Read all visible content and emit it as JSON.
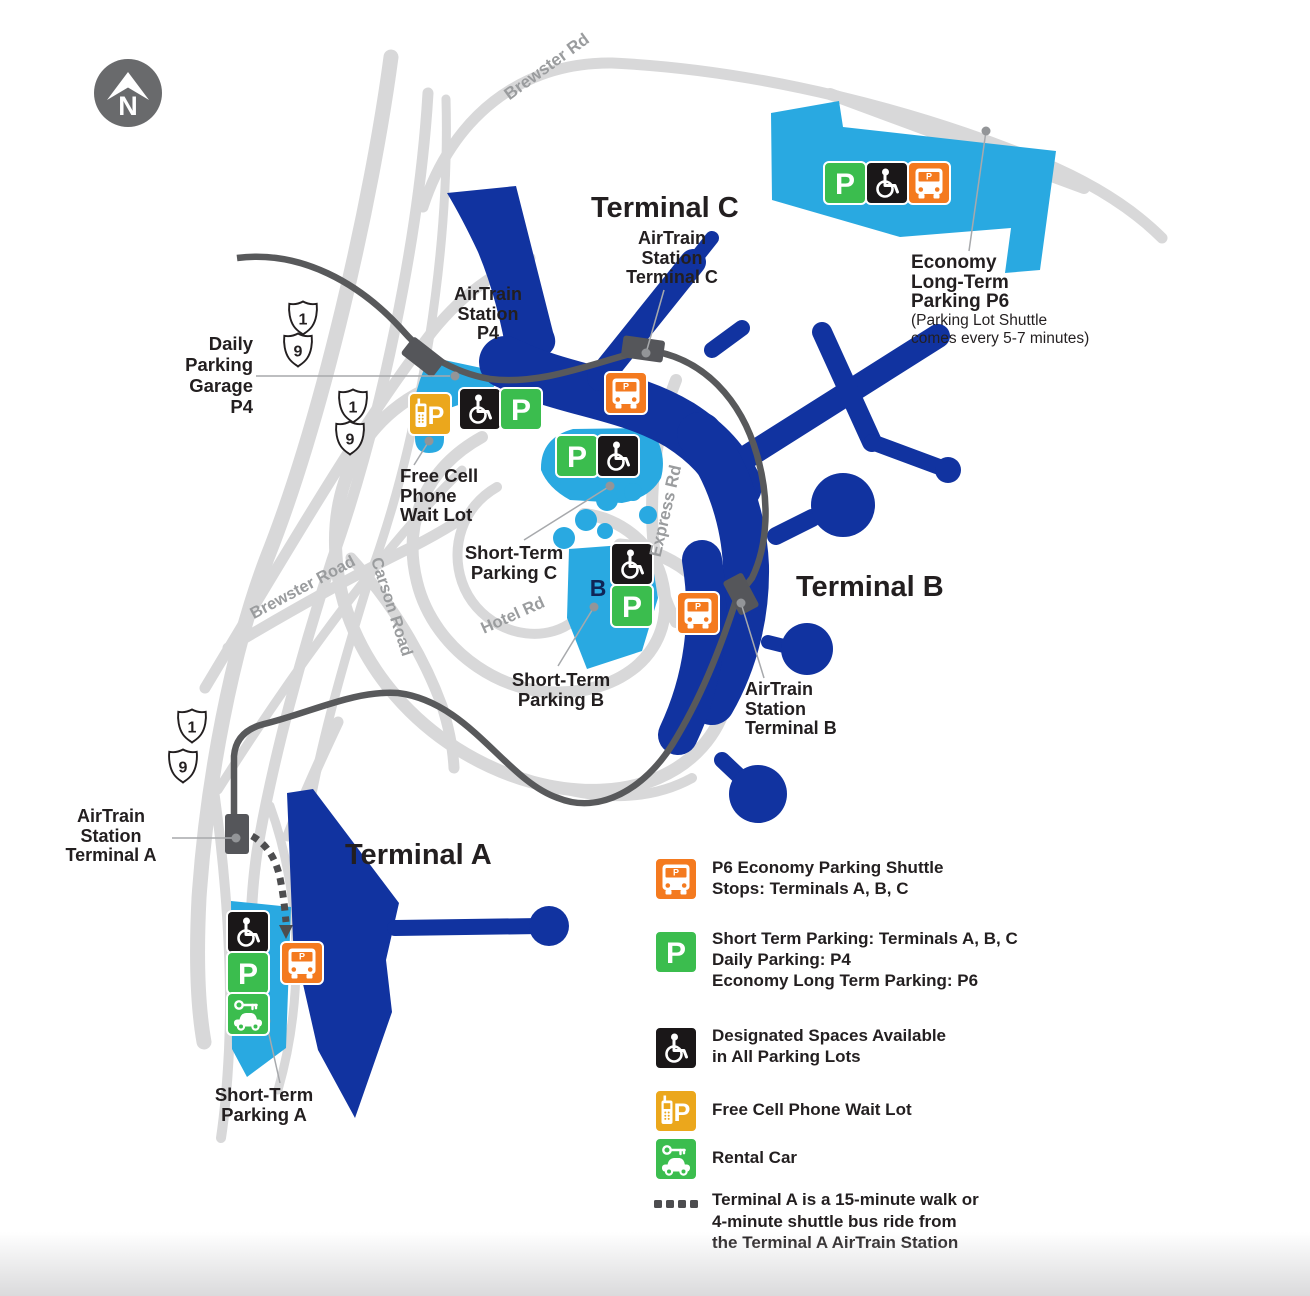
{
  "colors": {
    "blue": "#1133A0",
    "lot": "#29A9E1",
    "road": "#D8D8D9",
    "rail": "#58595B",
    "green": "#3BBD4E",
    "orange": "#F47A1F",
    "gold": "#EBA71C",
    "black": "#1A1718",
    "ink": "#231F20",
    "roadlabel": "#9A9C9E",
    "leader": "#A7A9AC",
    "dot": "#939598",
    "compass": "#696A6C",
    "navy": "#0F2557"
  },
  "compass": {
    "letter": "N"
  },
  "roads": {
    "brewster_top": "Brewster Rd",
    "brewster_road": "Brewster Road",
    "carson_road": "Carson Road",
    "hotel_rd": "Hotel Rd",
    "express_rd": "Express Rd"
  },
  "route_shields": [
    "1",
    "9",
    "1",
    "9",
    "1",
    "9"
  ],
  "icons": {
    "parking_letter": "P",
    "shuttle_letter": "P"
  },
  "labels": {
    "terminal_c": "Terminal C",
    "terminal_b": "Terminal B",
    "terminal_a": "Terminal A",
    "airtrain_c": "AirTrain\nStation\nTerminal C",
    "airtrain_b": "AirTrain\nStation\nTerminal B",
    "airtrain_a": "AirTrain\nStation\nTerminal A",
    "airtrain_p4": "AirTrain\nStation\nP4",
    "daily_parking": "Daily\nParking\nGarage\nP4",
    "free_cell": "Free Cell\nPhone\nWait Lot",
    "economy_p6": "Economy\nLong-Term\nParking P6",
    "economy_p6_note": "(Parking Lot Shuttle\ncomes every 5-7 minutes)",
    "short_term_c": "Short-Term\nParking C",
    "short_term_b": "Short-Term\nParking B",
    "short_term_b_letter": "B",
    "short_term_a": "Short-Term\nParking A"
  },
  "legend": {
    "shuttle": "P6 Economy Parking Shuttle\nStops: Terminals A, B, C",
    "parking": "Short Term Parking: Terminals A, B, C\nDaily Parking: P4\nEconomy Long Term Parking: P6",
    "ada": "Designated Spaces Available\nin All Parking Lots",
    "cell": "Free Cell Phone Wait Lot",
    "rental": "Rental Car",
    "walk": "Terminal A is a 15-minute walk or\n4-minute shuttle bus ride from\nthe Terminal A AirTrain Station"
  }
}
